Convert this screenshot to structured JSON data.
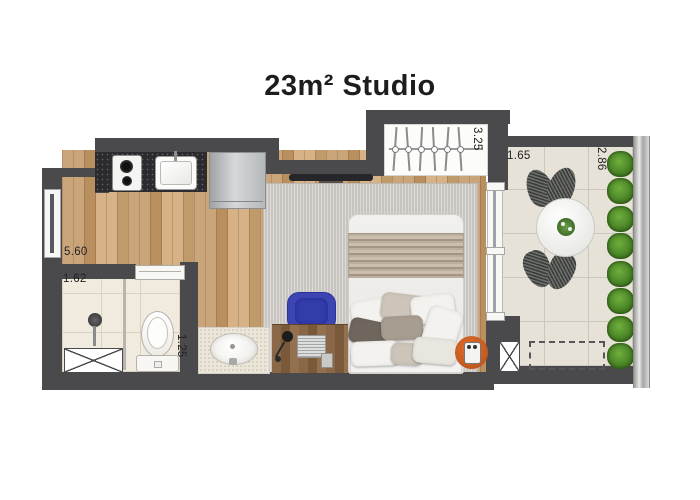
{
  "title": "23m² Studio",
  "dimensions": {
    "studio_side": "5.60",
    "bathroom_side": "1.62",
    "bathroom_depth": "1.25",
    "wardrobe": "3.25",
    "balcony_width": "1.65",
    "balcony_depth": "2.86"
  },
  "colors": {
    "wall": "#4a4a4c",
    "wood_floor": "#c29e71",
    "bathroom_tile": "#f1ebdf",
    "balcony_tile": "#e7e2d8",
    "rug": "#cbc8c4",
    "accent_orange": "#c2571f",
    "desk_chair_blue": "#3c45b2",
    "plant_green": "#4a8526",
    "title_text": "#1d1d1f"
  },
  "fixtures": [
    "kitchen-cooktop",
    "kitchen-sink",
    "refrigerator",
    "tv",
    "wardrobe-with-hangers",
    "double-bed",
    "pillows",
    "blanket",
    "rug",
    "desk",
    "laptop",
    "desk-lamp",
    "desk-chair",
    "orange-side-table",
    "window",
    "sliding-balcony-door",
    "bathroom-sliding-door",
    "shower",
    "shower-tray",
    "toilet",
    "vanity-sink",
    "glass-partition",
    "balcony-round-table",
    "wire-chairs",
    "planter-row",
    "glass-railing",
    "ac-unit-dashed-area",
    "duct-crossed-box"
  ]
}
